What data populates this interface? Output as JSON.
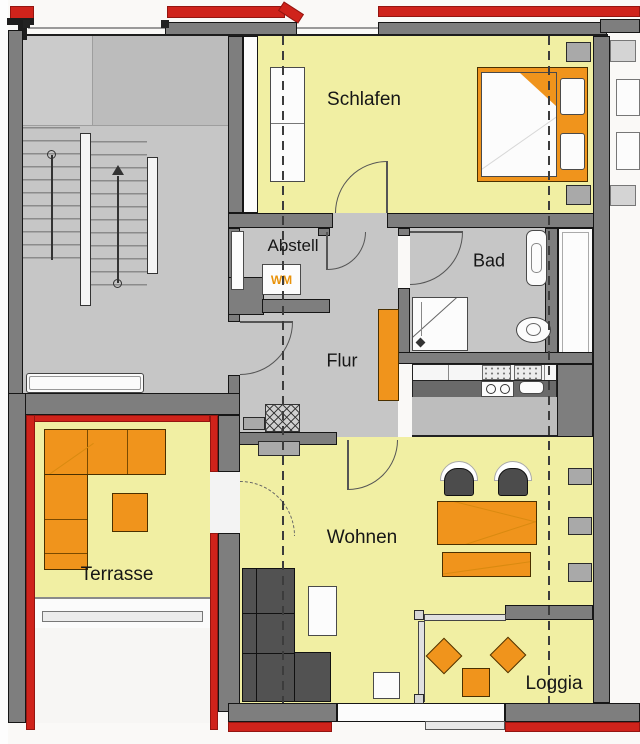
{
  "rooms": {
    "schlafen": "Schlafen",
    "abstell": "Abstell",
    "bad": "Bad",
    "flur": "Flur",
    "wohnen": "Wohnen",
    "terrasse": "Terrasse",
    "loggia": "Loggia"
  },
  "appliances": {
    "washing_machine": "WM"
  },
  "colors": {
    "room_fill": "#f1efa3",
    "circulation_fill": "#c6c6c6",
    "wall": "#7e7e7e",
    "new_wall_marker": "#cf231b",
    "furniture_orange": "#f0941c",
    "dark_upholstery": "#525252"
  }
}
